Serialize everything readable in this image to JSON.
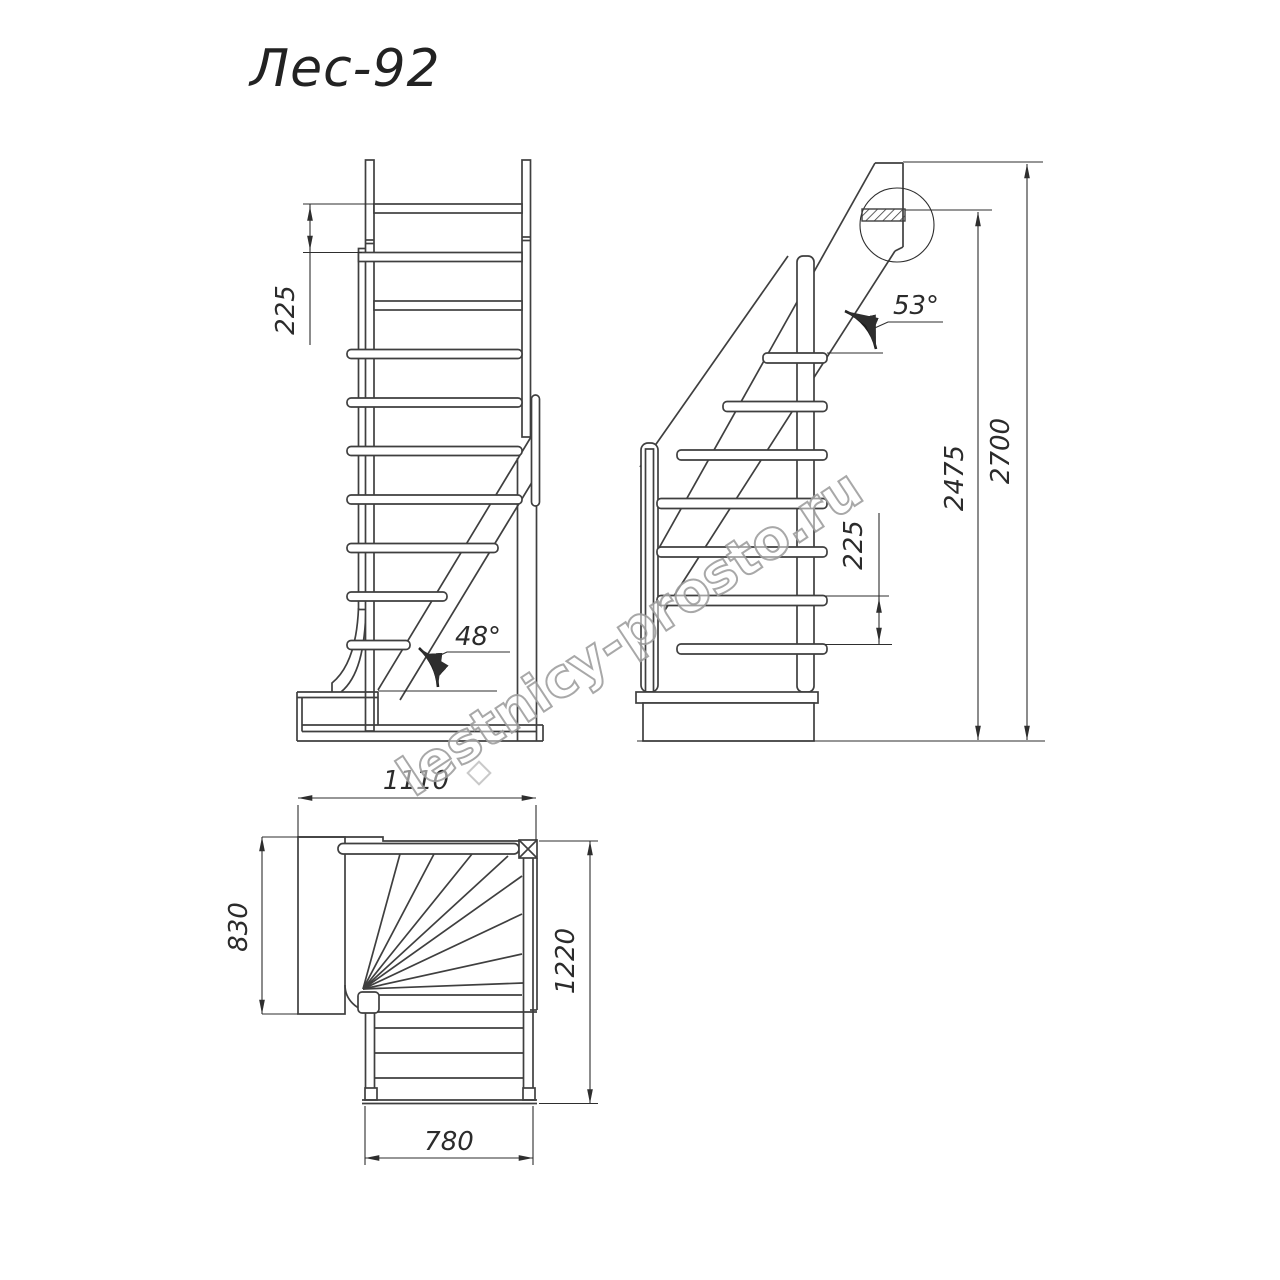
{
  "title": "Лес-92",
  "watermark": {
    "text": "lestnicy-prosto.ru"
  },
  "views": {
    "front": {
      "step_height": "225",
      "slope_angle": "48°"
    },
    "side": {
      "slope_angle": "53°",
      "step_height": "225",
      "underside_height": "2475",
      "total_height": "2700"
    },
    "plan": {
      "top_width": "1110",
      "landing_depth": "830",
      "total_depth": "1220",
      "flight_width": "780"
    }
  },
  "colors": {
    "background": "#ffffff",
    "line": "#3f3f3f",
    "dim_line": "#2e2e2e",
    "text": "#2b2b2b",
    "watermark": "#9f9f9f"
  }
}
